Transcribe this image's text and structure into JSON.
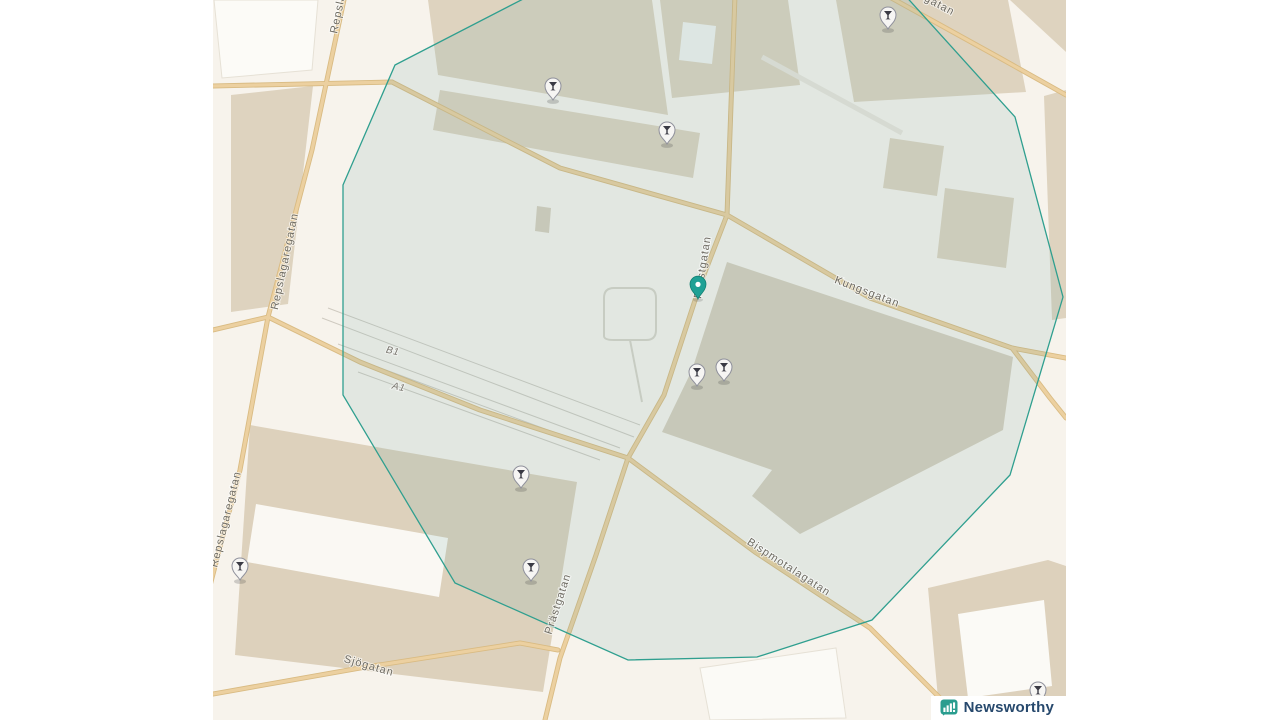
{
  "map": {
    "labels": {
      "repslagaregatan": "Repslagaregatan",
      "kungsgatan": "Kungsgatan",
      "prastgatan": "Prästgatan",
      "bispmotalagatan": "Bispmotalagatan",
      "sjogatan": "Sjögatan",
      "platform_b1": "B1",
      "platform_a1": "A1",
      "street_partial_top_right": "gatan"
    },
    "overlay": {
      "stroke": "#2f9f8f",
      "fill": "rgba(100,165,160,0.14)"
    },
    "markers": {
      "bar_pins": [
        {
          "x": 888,
          "y": 16
        },
        {
          "x": 553,
          "y": 87
        },
        {
          "x": 667,
          "y": 131
        },
        {
          "x": 697,
          "y": 373
        },
        {
          "x": 724,
          "y": 368
        },
        {
          "x": 521,
          "y": 475
        },
        {
          "x": 531,
          "y": 568
        },
        {
          "x": 240,
          "y": 567
        },
        {
          "x": 1038,
          "y": 691
        }
      ],
      "location_pin": {
        "x": 698,
        "y": 299,
        "color": "#1fa195"
      }
    },
    "colors": {
      "land": "#f7f3ec",
      "building": "#ded3bf",
      "road_major": "#e8c globally"
    }
  },
  "branding": {
    "logo_text": "Newsworthy",
    "logo_color": "#27496d",
    "icon_color": "#2a9d8f"
  }
}
